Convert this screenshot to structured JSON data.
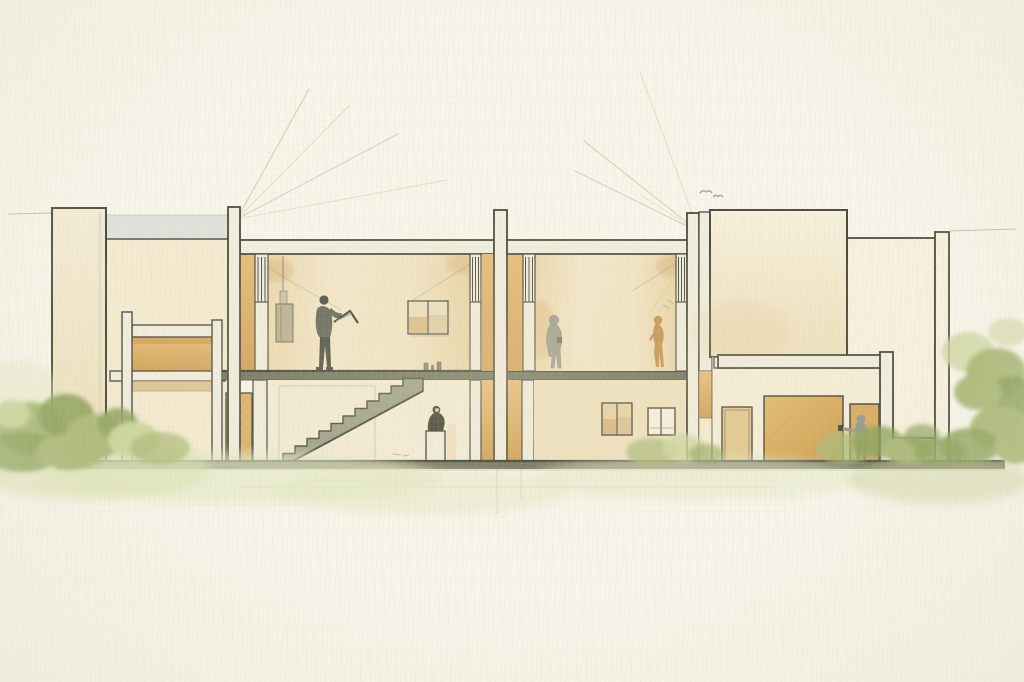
{
  "palette": {
    "paper": "#f8f6eb",
    "paperShade": "#eceadb",
    "line": "#4b4a3f",
    "lineSoft": "#8a887a",
    "wall": "#f4ebd1",
    "wallLight": "#f7f1de",
    "wallWarm": "#efe2bf",
    "structure": "#f1eedf",
    "structureShade": "#d9d6c3",
    "interior": "#f1e5c2",
    "interiorWarm": "#e8d3a3",
    "orange": "#dcb26c",
    "orangeDeep": "#cf9c4f",
    "wood": "#dcb266",
    "woodDark": "#c79a4e",
    "slab": "#6e735e",
    "slabDark": "#3d4034",
    "stair": "#99a087",
    "stairDark": "#5c6150",
    "glass": "#c7ccca",
    "figGray": "#989c8e",
    "figDark": "#5f6357",
    "figShadow": "#474a40",
    "bronze": "#c3914a",
    "banner": "#b9af93",
    "artworkPale": "#ece0bd",
    "green1": "#cdd69f",
    "green2": "#abb978",
    "green3": "#8ea25c",
    "greenPale": "#e4e9c4",
    "rayTan": "#d2ae6d",
    "rayGray": "#a39f8f"
  },
  "scene": {
    "type": "watercolor-architectural-section",
    "figures": [
      "visitor-with-folio-in-left-gallery",
      "gray-visitor-in-right-gallery",
      "bronze-figure-in-right-gallery",
      "seated-statue-on-pedestal",
      "person-at-entry-door"
    ],
    "artworks": [
      "hanging-scroll",
      "two-panel-painting",
      "small-vessels-on-floor-edge",
      "lower-gallery-window-left",
      "lower-gallery-window-right"
    ],
    "architecture": [
      "left-pylon",
      "clerestory-glass-band",
      "mezzanine-annex",
      "left-double-height-gallery",
      "central-stair",
      "right-double-height-gallery",
      "entry-hall-with-doors",
      "tall-block-a",
      "tall-block-b",
      "right-pylon",
      "ground-plinth"
    ],
    "nature": [
      "left-shrub-cluster",
      "right-shrub-cluster",
      "grass-washes",
      "birds",
      "sun-ray-fans"
    ]
  }
}
